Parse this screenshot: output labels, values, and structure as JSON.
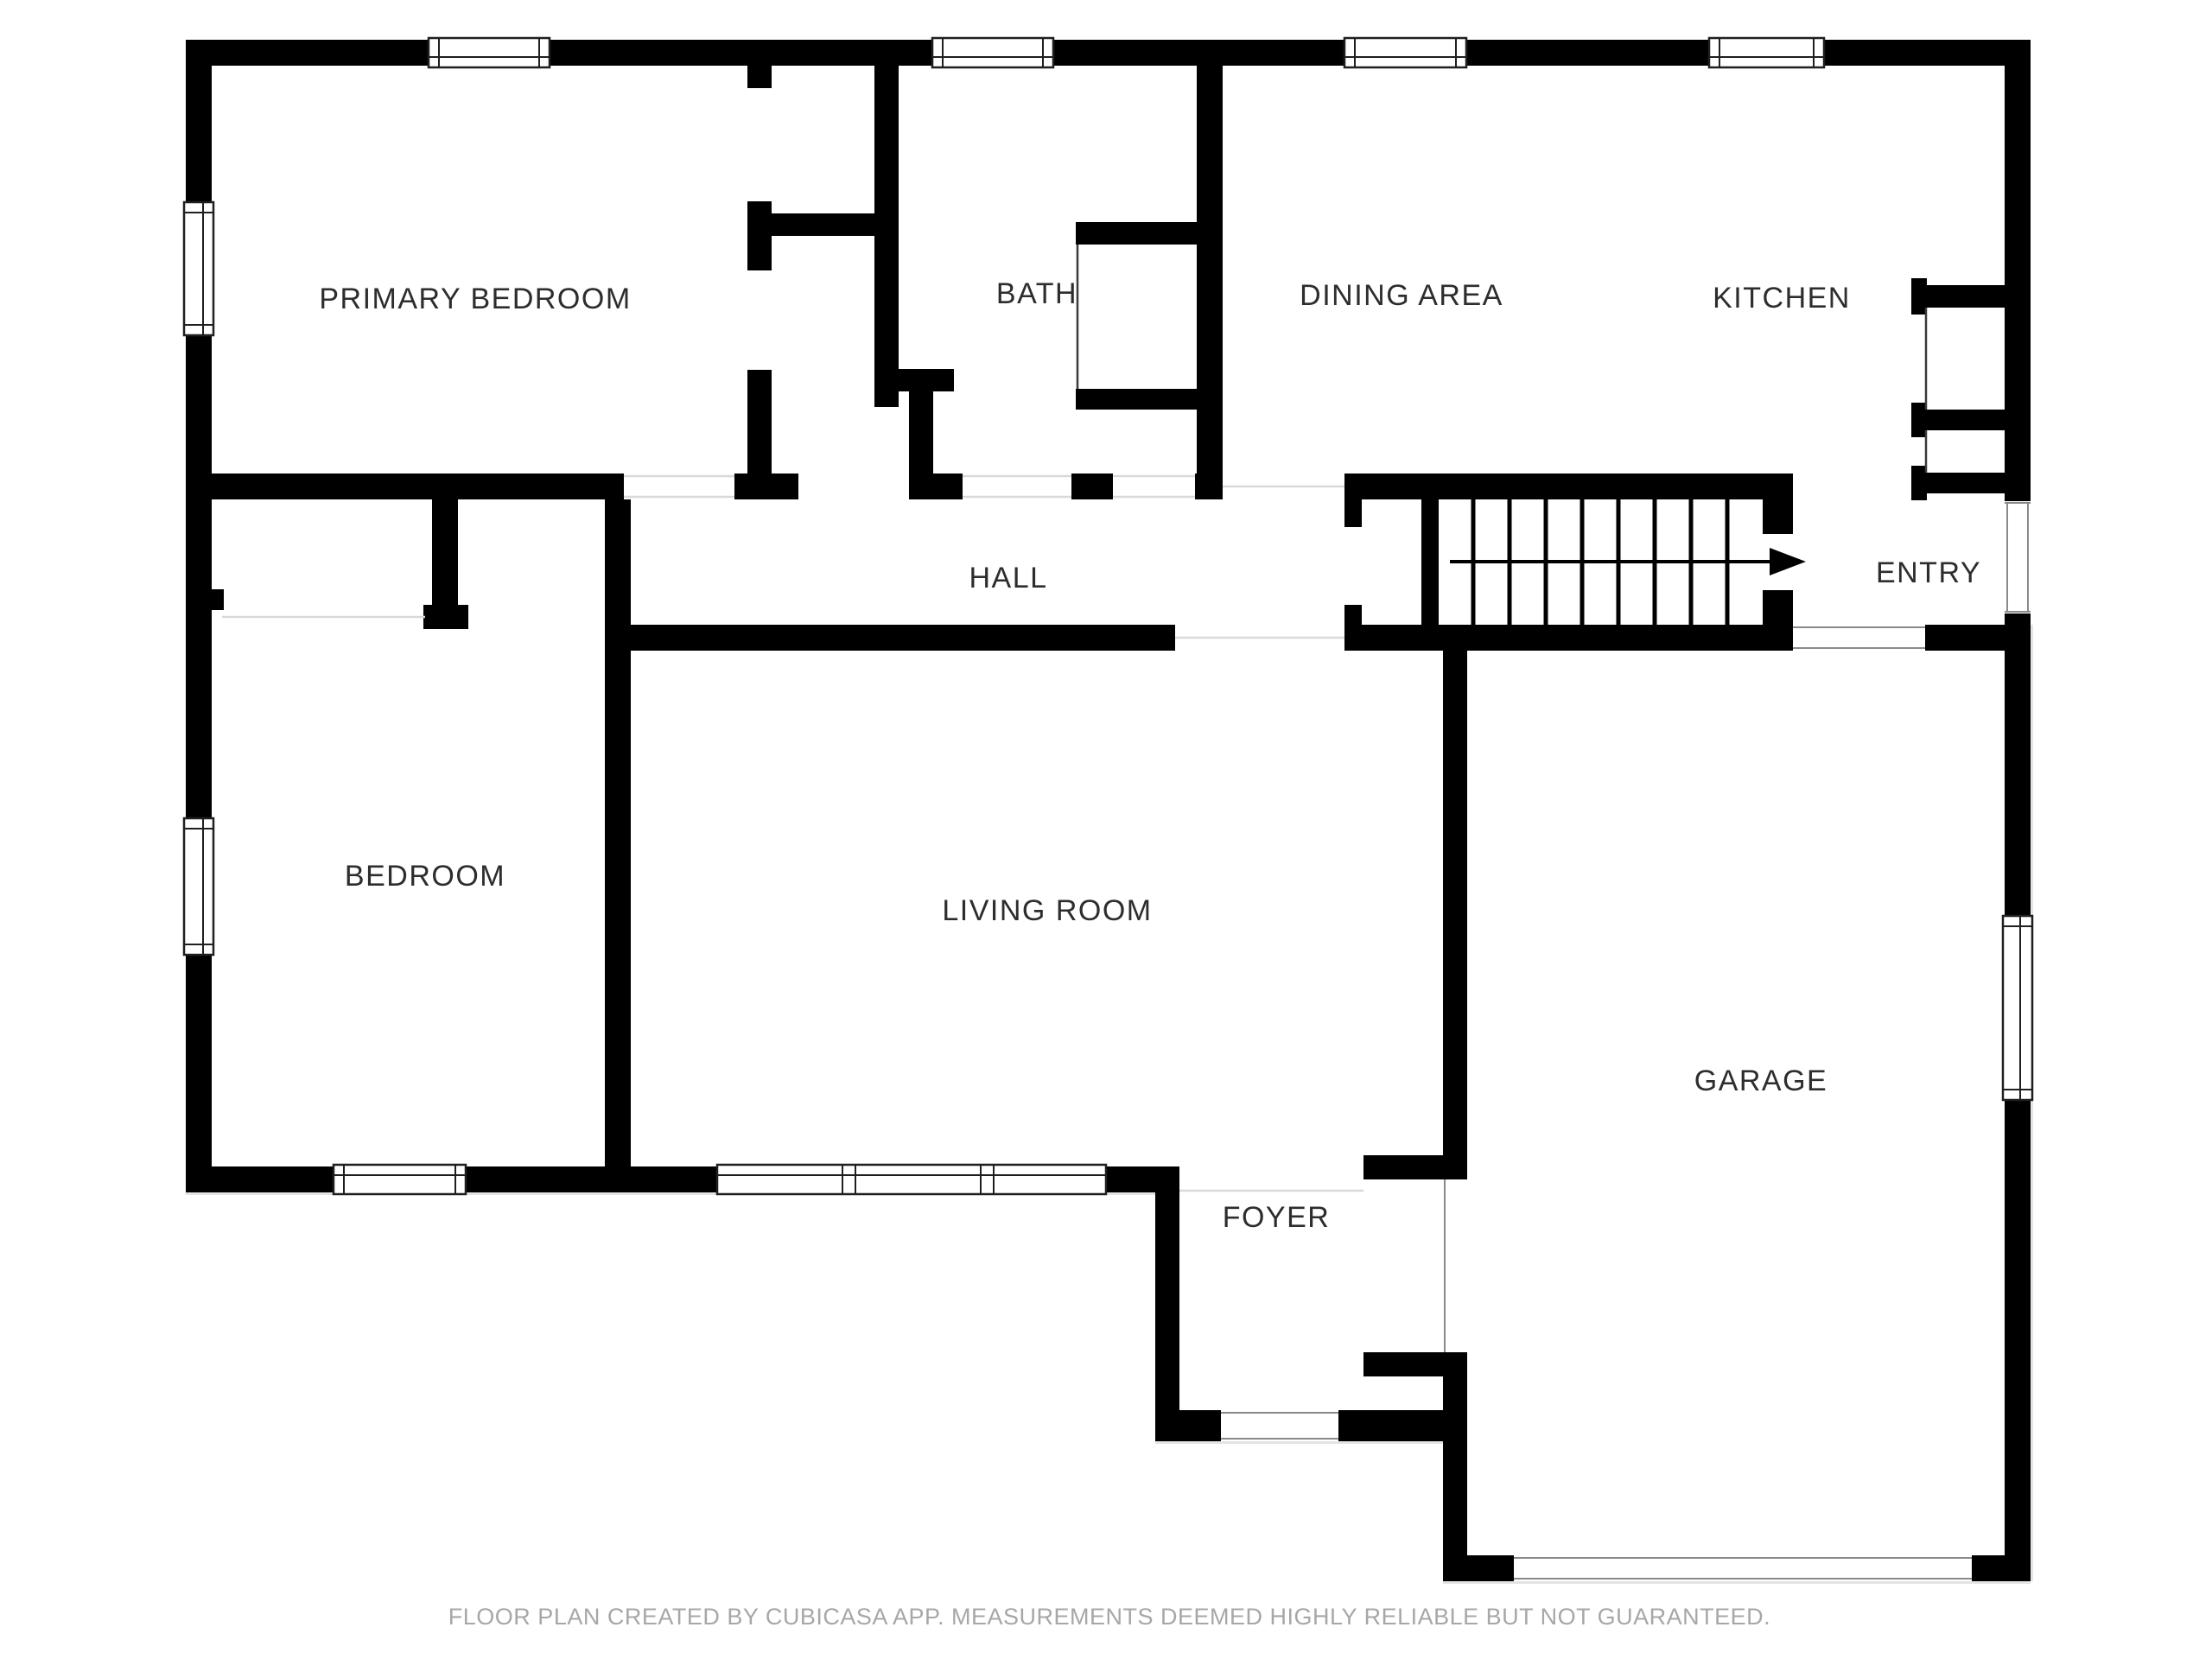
{
  "plan": {
    "title": "floor-plan",
    "colors": {
      "background": "#ffffff",
      "wall": "#000000",
      "room_label": "#2d2d2d",
      "footer_text": "#a7a7a7",
      "window_frame": "#1f1f1f"
    },
    "rooms": [
      {
        "id": "primary-bedroom",
        "label": "PRIMARY BEDROOM"
      },
      {
        "id": "bath",
        "label": "BATH"
      },
      {
        "id": "dining-area",
        "label": "DINING AREA"
      },
      {
        "id": "kitchen",
        "label": "KITCHEN"
      },
      {
        "id": "hall",
        "label": "HALL"
      },
      {
        "id": "entry",
        "label": "ENTRY"
      },
      {
        "id": "bedroom",
        "label": "BEDROOM"
      },
      {
        "id": "living-room",
        "label": "LIVING ROOM"
      },
      {
        "id": "garage",
        "label": "GARAGE"
      },
      {
        "id": "foyer",
        "label": "FOYER"
      }
    ],
    "stairs": {
      "icon": "stairs-up-arrow",
      "direction": "right",
      "treads": 9
    },
    "footer": "FLOOR PLAN CREATED BY CUBICASA APP. MEASUREMENTS DEEMED HIGHLY RELIABLE BUT NOT GUARANTEED."
  }
}
